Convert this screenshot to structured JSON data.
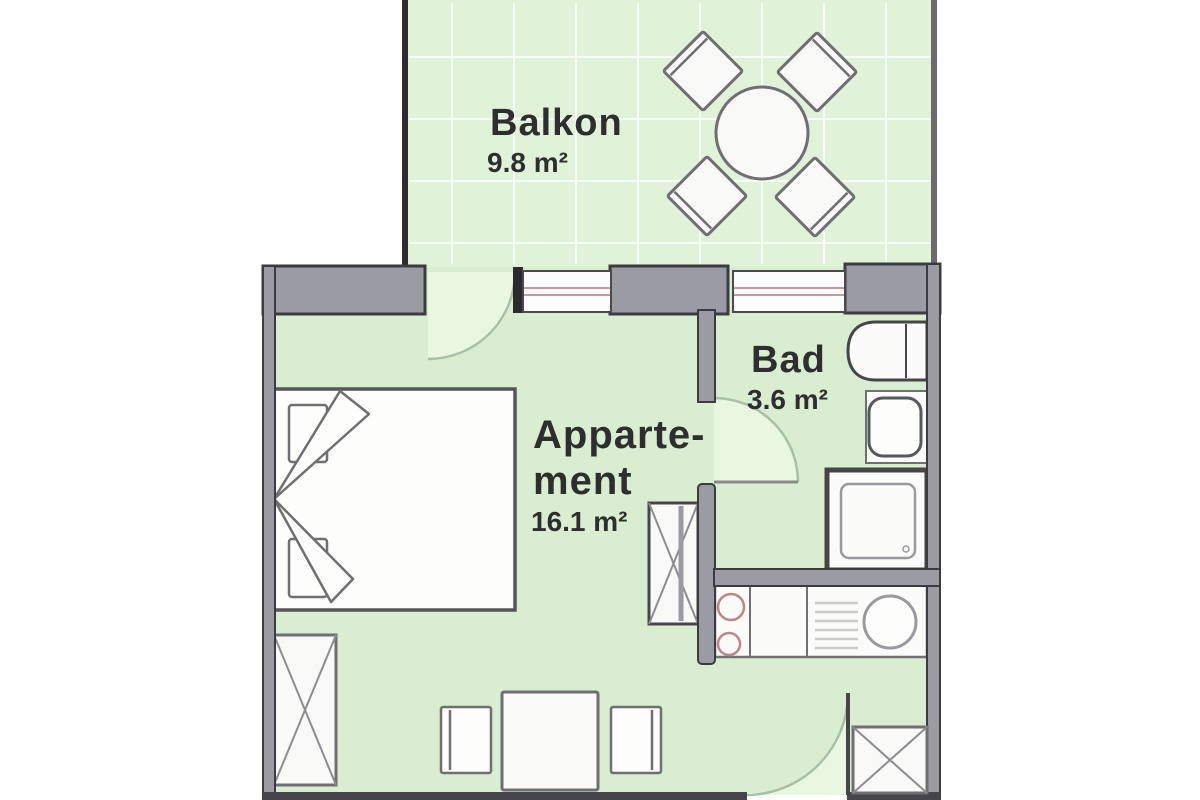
{
  "title": "apartment-floor-plan",
  "rooms": {
    "balkon": {
      "name": "Balkon",
      "area": "9.8 m²"
    },
    "appartement": {
      "name_line1": "Apparte-",
      "name_line2": "ment",
      "area": "16.1 m²"
    },
    "bad": {
      "name": "Bad",
      "area": "3.6 m²"
    }
  },
  "fixtures": [
    "round-table",
    "chair",
    "bed",
    "pillow",
    "blanket-fold",
    "wardrobe",
    "dining-table",
    "dining-chair",
    "cabinet",
    "entry-cabinet",
    "bathtub",
    "washbasin",
    "shower",
    "kitchenette",
    "stove-burners",
    "drainer",
    "kitchen-sink",
    "window",
    "balcony-door",
    "bathroom-door",
    "entrance-door",
    "balcony-railing"
  ],
  "colors": {
    "floor_green": "#d9eed0",
    "balcony_green": "#e0f3d8",
    "wedge_green": "#e9f7e1",
    "grid_line": "#ffffff",
    "wall_fill": "#9b9ba3",
    "wall_outline": "#3b3b40",
    "dark_wall": "#46464a",
    "furniture_outline": "#6f6f73",
    "window_glass": "#fcfcfc",
    "window_line": "#c49aa2",
    "door_arc": "#a9bfa7",
    "burner_line": "#bb8888",
    "text": "#2e2e30"
  }
}
